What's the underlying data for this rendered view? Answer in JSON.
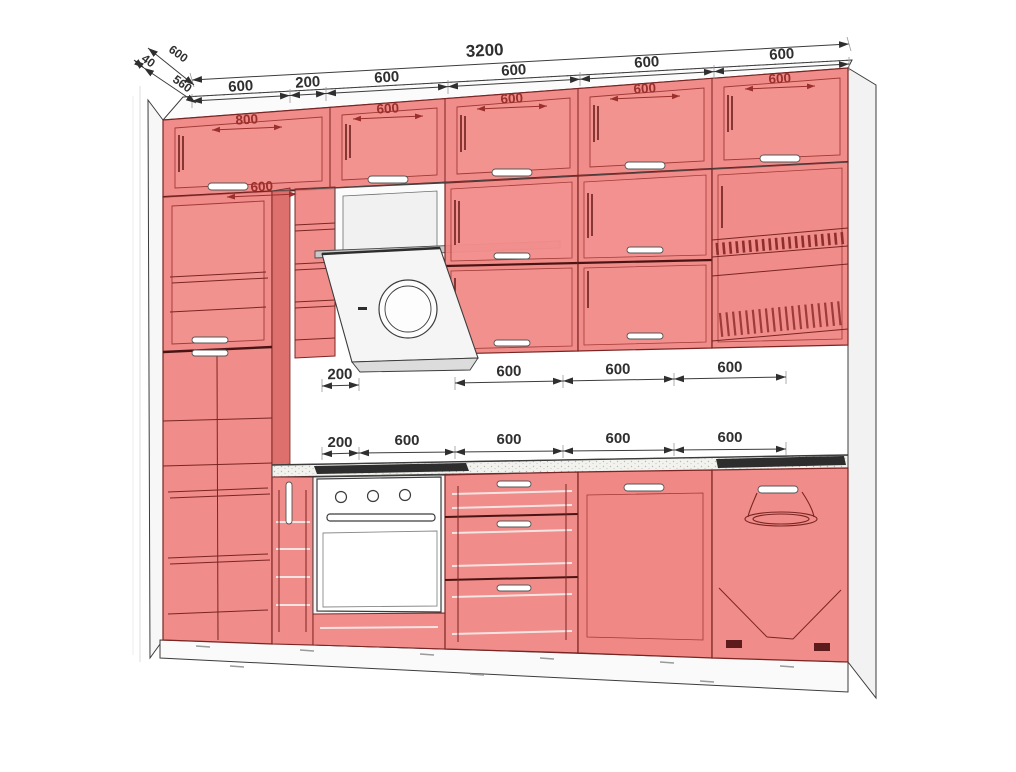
{
  "drawing": {
    "title": "kitchen-elevation-3d-wireframe",
    "colors": {
      "cabinet_fill": "#ef827f",
      "cabinet_fill_light": "#f49693",
      "cabinet_side": "#d95f5d",
      "cabinet_edge": "#7a2523",
      "outline": "#3c3c3c",
      "dimension_text": "#2f2f2f",
      "interior_dimension_text": "#9a2f2c",
      "appliance_dark": "#2d2d2d",
      "background": "#ffffff"
    },
    "dims": {
      "total": "3200",
      "top_segments": [
        "600",
        "200",
        "600",
        "600",
        "600",
        "600"
      ],
      "depth": {
        "total": "600",
        "gap": "40",
        "body": "560"
      },
      "upper_cabinets": [
        "800",
        "600",
        "600",
        "600",
        "600"
      ],
      "tall_cabinet": "600",
      "wall_row": [
        "200",
        "600",
        "600",
        "600"
      ],
      "base_row": [
        "200",
        "600",
        "600",
        "600",
        "600"
      ]
    }
  }
}
